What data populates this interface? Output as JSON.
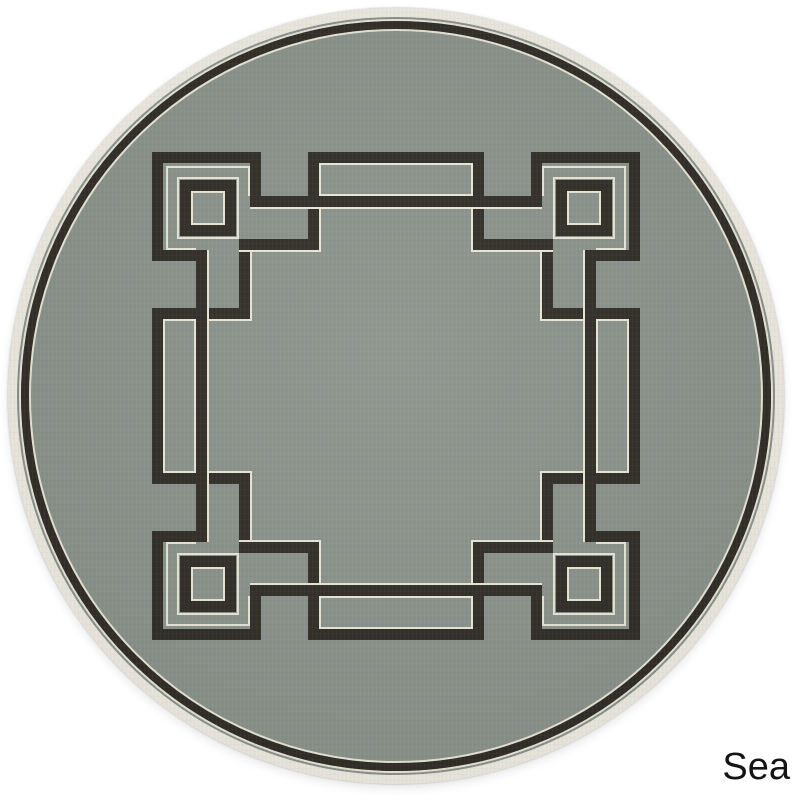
{
  "page": {
    "background": "#ffffff"
  },
  "label": {
    "text": "Sea",
    "color": "#141414"
  },
  "rug": {
    "center_x": 396,
    "center_y": 396,
    "outer_diameter": 776,
    "colors": {
      "field": "#8b948c",
      "line": "#312d27",
      "ivory": "#eae8da",
      "rim": "#f0eee3"
    },
    "rings": [
      {
        "name": "border-ring-outer-accent",
        "x": 19,
        "d": 754,
        "b": 2,
        "c": "ivory"
      },
      {
        "name": "border-ring",
        "x": 21,
        "d": 750,
        "b": 9,
        "c": "line"
      },
      {
        "name": "border-ring-inner-accent",
        "x": 29,
        "d": 734,
        "b": 2,
        "c": "ivory"
      }
    ],
    "pattern": {
      "mirror_span": 792,
      "corner_tl": [
        {
          "k": "ivory-border",
          "x": 177,
          "y": 177,
          "w": 62,
          "h": 62
        },
        {
          "k": "dark-border",
          "x": 180,
          "y": 180,
          "w": 56,
          "h": 56,
          "bw": 11
        },
        {
          "k": "ivory-border",
          "x": 191,
          "y": 191,
          "w": 34,
          "h": 34
        },
        {
          "k": "dark",
          "x": 152,
          "y": 152,
          "w": 109,
          "h": 11
        },
        {
          "k": "dark",
          "x": 152,
          "y": 152,
          "w": 11,
          "h": 109
        },
        {
          "k": "dark",
          "x": 250,
          "y": 152,
          "w": 11,
          "h": 55
        },
        {
          "k": "dark",
          "x": 152,
          "y": 250,
          "w": 55,
          "h": 11
        },
        {
          "k": "dark",
          "x": 308,
          "y": 207,
          "w": 11,
          "h": 43
        },
        {
          "k": "dark",
          "x": 239,
          "y": 239,
          "w": 80,
          "h": 11
        },
        {
          "k": "dark",
          "x": 239,
          "y": 239,
          "w": 11,
          "h": 80
        },
        {
          "k": "dark",
          "x": 207,
          "y": 308,
          "w": 43,
          "h": 11
        },
        {
          "k": "ivory",
          "x": 166,
          "y": 166,
          "w": 84,
          "h": 2
        },
        {
          "k": "ivory",
          "x": 166,
          "y": 166,
          "w": 2,
          "h": 84
        },
        {
          "k": "ivory",
          "x": 248,
          "y": 166,
          "w": 2,
          "h": 30
        },
        {
          "k": "ivory",
          "x": 166,
          "y": 248,
          "w": 30,
          "h": 2
        },
        {
          "k": "ivory",
          "x": 319,
          "y": 207,
          "w": 2,
          "h": 45
        },
        {
          "k": "ivory",
          "x": 239,
          "y": 250,
          "w": 82,
          "h": 2
        },
        {
          "k": "ivory",
          "x": 250,
          "y": 250,
          "w": 2,
          "h": 71
        },
        {
          "k": "ivory",
          "x": 207,
          "y": 319,
          "w": 45,
          "h": 2
        }
      ],
      "side_top": [
        {
          "k": "dark",
          "x": 250,
          "y": 196,
          "w": 292,
          "h": 11
        },
        {
          "k": "ivory",
          "x": 250,
          "y": 207,
          "w": 292,
          "h": 2
        },
        {
          "k": "dark-border",
          "x": 308,
          "y": 152,
          "w": 176,
          "h": 55,
          "bw": 11
        },
        {
          "k": "ivory-border",
          "x": 319,
          "y": 163,
          "w": 154,
          "h": 33
        }
      ]
    }
  }
}
